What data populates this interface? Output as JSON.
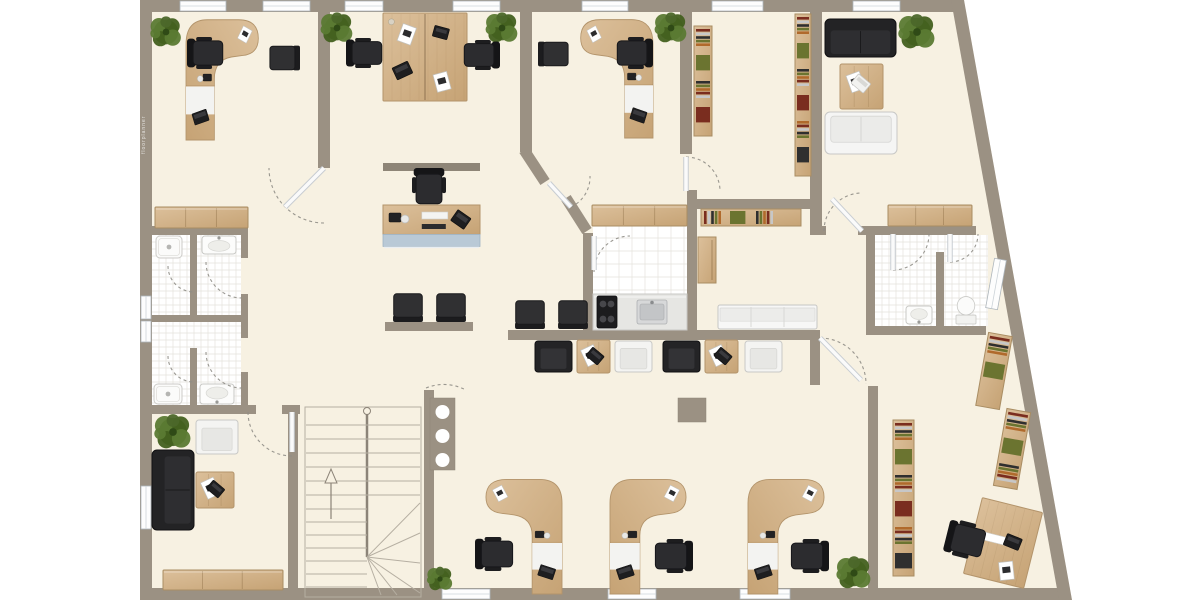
{
  "watermark": {
    "text": "floorplanner"
  },
  "palette": {
    "outside": "#ffffff",
    "floor": "#f7f1e2",
    "wall": "#9b9183",
    "wall_dark": "#8d8376",
    "wood1": "#dcc09b",
    "wood2": "#c6a375",
    "wood_line": "#b3946b",
    "dark": "#2c2c2f",
    "dark_edge": "#17171a",
    "white_f": "#f5f5f4",
    "white_edge": "#c8c8c6",
    "tile": "#ffffff",
    "tile_line": "#e4e2dd",
    "blue_front": "#b9c9d6",
    "blue_edge": "#9fb3c4",
    "window_frame": "#aeb6bc",
    "arc": "#8f8d86",
    "plant_a": "#4c672a",
    "plant_b": "#5b7a33",
    "plant_c": "#43601f",
    "books": [
      "#7a2d1f",
      "#c7c7c7",
      "#2f2f2f",
      "#6b7430",
      "#b06a2c"
    ]
  },
  "building": {
    "outline": [
      [
        140,
        0
      ],
      [
        964,
        0
      ],
      [
        1072,
        600
      ],
      [
        140,
        600
      ]
    ],
    "walls_ext": [
      [
        140,
        0,
        824,
        12
      ],
      [
        140,
        0,
        12,
        600
      ],
      [
        140,
        588,
        919,
        12
      ]
    ],
    "wall_slant": [
      [
        951,
        0
      ],
      [
        964,
        0
      ],
      [
        1072,
        600
      ],
      [
        1059,
        600
      ]
    ],
    "walls": [
      [
        318,
        12,
        12,
        156
      ],
      [
        520,
        12,
        12,
        140
      ],
      [
        680,
        12,
        12,
        142
      ],
      [
        810,
        12,
        12,
        218
      ],
      [
        152,
        226,
        96,
        9
      ],
      [
        190,
        235,
        7,
        82
      ],
      [
        190,
        348,
        7,
        57
      ],
      [
        241,
        226,
        7,
        32
      ],
      [
        241,
        294,
        7,
        44
      ],
      [
        241,
        372,
        7,
        36
      ],
      [
        152,
        315,
        96,
        7
      ],
      [
        152,
        405,
        104,
        9
      ],
      [
        282,
        405,
        18,
        9
      ],
      [
        288,
        405,
        10,
        193
      ],
      [
        424,
        390,
        10,
        208
      ],
      [
        385,
        322,
        88,
        9
      ],
      [
        508,
        330,
        302,
        10
      ],
      [
        810,
        330,
        10,
        55
      ],
      [
        868,
        386,
        10,
        202
      ],
      [
        687,
        199,
        127,
        10
      ],
      [
        687,
        190,
        10,
        142
      ],
      [
        583,
        233,
        10,
        99
      ],
      [
        866,
        226,
        110,
        9
      ],
      [
        866,
        226,
        9,
        108
      ],
      [
        936,
        252,
        8,
        83
      ],
      [
        866,
        326,
        120,
        9
      ],
      [
        810,
        226,
        16,
        9
      ],
      [
        858,
        226,
        8,
        9
      ]
    ],
    "diag_walls": [
      [
        524,
        150,
        545,
        182
      ],
      [
        566,
        198,
        587,
        231
      ]
    ],
    "windows_h": [
      [
        180,
        1,
        46
      ],
      [
        263,
        1,
        47
      ],
      [
        345,
        1,
        38
      ],
      [
        453,
        1,
        47
      ],
      [
        582,
        1,
        46
      ],
      [
        712,
        1,
        51
      ],
      [
        853,
        1,
        47
      ],
      [
        442,
        589,
        48
      ],
      [
        608,
        589,
        48
      ],
      [
        740,
        589,
        50
      ]
    ],
    "windows_v": [
      [
        141,
        296,
        23
      ],
      [
        141,
        321,
        21
      ],
      [
        141,
        486,
        43
      ]
    ],
    "window_slant": {
      "x": 990,
      "y": 259,
      "w": 12,
      "h": 50,
      "rot": 10.2,
      "cx": 996,
      "cy": 284
    },
    "tile_floors": [
      [
        152,
        235,
        89,
        170,
        7
      ],
      [
        875,
        235,
        113,
        91,
        7
      ],
      [
        593,
        225,
        94,
        105,
        13
      ]
    ],
    "pillar": [
      678,
      398,
      28,
      24
    ],
    "panel": {
      "x": 430,
      "y": 398,
      "w": 25,
      "h": 72,
      "holes": 3
    },
    "doors": [
      {
        "leaf": [
          324,
          168,
          285,
          207
        ],
        "arc": "M324 223 A55 55 0 0 1 269 168"
      },
      {
        "leaf": [
          549,
          183,
          571,
          207
        ],
        "arc": "M571 207 A33 33 0 0 0 590 176"
      },
      {
        "leaf": [
          686,
          157,
          686,
          191
        ],
        "arc": "M686 157 A34 34 0 0 1 720 191"
      },
      {
        "leaf": [
          862,
          231,
          832,
          199
        ],
        "arc": "M824 231 A38 38 0 0 1 862 193"
      },
      {
        "leaf": [
          820,
          338,
          861,
          380
        ],
        "arc": "M820 338 A46 46 0 0 1 866 384"
      },
      {
        "leaf": [
          893,
          234,
          893,
          270
        ],
        "arc": "M893 270 A36 36 0 0 0 929 234"
      },
      {
        "leaf": [
          950,
          234,
          950,
          262
        ],
        "arc": "M950 262 A28 28 0 0 0 978 234"
      },
      {
        "leaf": [
          292,
          412,
          292,
          452
        ],
        "arc": "M248 412 A44 44 0 0 0 292 456"
      },
      {
        "leaf": [
          594,
          236,
          594,
          270
        ],
        "arc": "M594 272 A36 36 0 0 1 630 236"
      },
      {
        "leaf": null,
        "arc": "M206 262 A36 36 0 0 0 242 298"
      },
      {
        "leaf": null,
        "arc": "M206 352 A36 36 0 0 0 242 388"
      },
      {
        "leaf": null,
        "arc": "M168 266 A26 26 0 0 0 194 292"
      },
      {
        "leaf": null,
        "arc": "M168 356 A26 26 0 0 0 194 382"
      },
      {
        "leaf": null,
        "arc": "M426 388 Q446 380 466 390"
      }
    ]
  },
  "stairs": {
    "x": 305,
    "y": 407,
    "w": 116,
    "h": 190
  },
  "furniture": [
    {
      "type": "plant",
      "name": "plant-office-1",
      "x": 152,
      "y": 18,
      "w": 28,
      "h": 28
    },
    {
      "type": "plant",
      "name": "plant-open-office-left",
      "x": 322,
      "y": 14,
      "w": 30,
      "h": 28
    },
    {
      "type": "plant",
      "name": "plant-open-office-right",
      "x": 487,
      "y": 14,
      "w": 30,
      "h": 28
    },
    {
      "type": "plant",
      "name": "plant-office-3",
      "x": 656,
      "y": 14,
      "w": 30,
      "h": 28
    },
    {
      "type": "plant",
      "name": "plant-lounge",
      "x": 900,
      "y": 16,
      "w": 34,
      "h": 32
    },
    {
      "type": "plant",
      "name": "plant-waiting-room",
      "x": 156,
      "y": 416,
      "w": 34,
      "h": 32
    },
    {
      "type": "plant",
      "name": "plant-bottom-right",
      "x": 838,
      "y": 558,
      "w": 32,
      "h": 30
    },
    {
      "type": "plant",
      "name": "plant-bottom-center",
      "x": 428,
      "y": 568,
      "w": 24,
      "h": 22
    },
    {
      "type": "desk-curved",
      "name": "desk-office-1",
      "x": 186,
      "y": 12,
      "w": 78,
      "h": 128,
      "mirror": true
    },
    {
      "type": "office-chair",
      "name": "chair-office-1",
      "x": 190,
      "y": 34,
      "w": 32,
      "h": 38,
      "rot": -90
    },
    {
      "type": "chair-visitor",
      "name": "visitor-chair-office-1",
      "x": 270,
      "y": 42,
      "w": 28,
      "h": 32,
      "rot": 90
    },
    {
      "type": "desk-double",
      "name": "double-desk-open-office",
      "x": 383,
      "y": 13,
      "w": 84,
      "h": 88
    },
    {
      "type": "office-chair",
      "name": "chair-open-office-left",
      "x": 350,
      "y": 34,
      "w": 30,
      "h": 38,
      "rot": -90
    },
    {
      "type": "office-chair",
      "name": "chair-open-office-right",
      "x": 466,
      "y": 36,
      "w": 30,
      "h": 38,
      "rot": 90
    },
    {
      "type": "desk-curved",
      "name": "desk-office-3",
      "x": 575,
      "y": 12,
      "w": 78,
      "h": 126
    },
    {
      "type": "office-chair",
      "name": "chair-office-3",
      "x": 618,
      "y": 34,
      "w": 32,
      "h": 38,
      "rot": 90
    },
    {
      "type": "chair-visitor",
      "name": "visitor-chair-office-3",
      "x": 540,
      "y": 38,
      "w": 28,
      "h": 32,
      "rot": -90
    },
    {
      "type": "shelf-books",
      "name": "bookshelf-storage-left",
      "x": 694,
      "y": 26,
      "w": 18,
      "h": 110
    },
    {
      "type": "shelf-books",
      "name": "bookshelf-storage-right",
      "x": 795,
      "y": 14,
      "w": 16,
      "h": 162
    },
    {
      "type": "sofa-dark",
      "name": "sofa-lounge-dark",
      "x": 825,
      "y": 19,
      "w": 71,
      "h": 38
    },
    {
      "type": "table-wood",
      "name": "coffee-table-lounge",
      "x": 840,
      "y": 64,
      "w": 43,
      "h": 45,
      "deco": "laptop-white"
    },
    {
      "type": "sofa-white",
      "name": "sofa-lounge-white",
      "x": 825,
      "y": 112,
      "w": 72,
      "h": 42,
      "rot": 180
    },
    {
      "type": "sideboard",
      "name": "sideboard-lounge",
      "x": 888,
      "y": 205,
      "w": 84,
      "h": 21
    },
    {
      "type": "sideboard",
      "name": "sideboard-corridor-left",
      "x": 155,
      "y": 207,
      "w": 93,
      "h": 21
    },
    {
      "type": "wall-shelf",
      "name": "wall-shelf-reception",
      "x": 383,
      "y": 163,
      "w": 97,
      "h": 8
    },
    {
      "type": "office-chair",
      "name": "chair-reception",
      "x": 412,
      "y": 168,
      "w": 34,
      "h": 38
    },
    {
      "type": "reception-desk",
      "name": "reception-desk",
      "x": 383,
      "y": 205,
      "w": 97,
      "h": 46
    },
    {
      "type": "chair-visitor",
      "name": "waiting-chair-1",
      "x": 391,
      "y": 292,
      "w": 34,
      "h": 30,
      "rot": 180
    },
    {
      "type": "chair-visitor",
      "name": "waiting-chair-2",
      "x": 434,
      "y": 292,
      "w": 34,
      "h": 30,
      "rot": 180
    },
    {
      "type": "chair-visitor",
      "name": "waiting-chair-3",
      "x": 513,
      "y": 299,
      "w": 34,
      "h": 30,
      "rot": 180
    },
    {
      "type": "chair-visitor",
      "name": "waiting-chair-4",
      "x": 556,
      "y": 299,
      "w": 34,
      "h": 30,
      "rot": 180
    },
    {
      "type": "sideboard",
      "name": "kitchen-upper-cabinets",
      "x": 592,
      "y": 205,
      "w": 95,
      "h": 21
    },
    {
      "type": "shelf-books",
      "name": "bookshelf-corridor-row",
      "x": 701,
      "y": 209,
      "w": 100,
      "h": 17
    },
    {
      "type": "cabinet-tall",
      "name": "kitchen-tall-cabinet",
      "x": 698,
      "y": 237,
      "w": 18,
      "h": 46
    },
    {
      "type": "counter",
      "name": "kitchen-counter",
      "x": 593,
      "y": 294,
      "w": 94,
      "h": 36
    },
    {
      "type": "stove",
      "name": "kitchen-stove",
      "x": 597,
      "y": 296,
      "w": 20,
      "h": 32
    },
    {
      "type": "sink",
      "name": "kitchen-sink",
      "x": 637,
      "y": 300,
      "w": 30,
      "h": 24
    },
    {
      "type": "armchair-dark",
      "name": "armchair-dark-1",
      "x": 535,
      "y": 341,
      "w": 37,
      "h": 31
    },
    {
      "type": "table-wood",
      "name": "side-table-1",
      "x": 577,
      "y": 340,
      "w": 33,
      "h": 33,
      "deco": "laptop-dark"
    },
    {
      "type": "armchair-white",
      "name": "armchair-white-1",
      "x": 615,
      "y": 341,
      "w": 37,
      "h": 31
    },
    {
      "type": "armchair-dark",
      "name": "armchair-dark-2",
      "x": 663,
      "y": 341,
      "w": 37,
      "h": 31
    },
    {
      "type": "table-wood",
      "name": "side-table-2",
      "x": 705,
      "y": 340,
      "w": 33,
      "h": 33,
      "deco": "laptop-dark"
    },
    {
      "type": "armchair-white",
      "name": "armchair-white-2",
      "x": 745,
      "y": 341,
      "w": 37,
      "h": 31
    },
    {
      "type": "bench-white",
      "name": "bench-white",
      "x": 718,
      "y": 305,
      "w": 99,
      "h": 24
    },
    {
      "type": "shower",
      "name": "shower-bath-upper",
      "x": 156,
      "y": 236,
      "w": 26,
      "h": 22
    },
    {
      "type": "sink-bath",
      "name": "sink-bath-upper",
      "x": 202,
      "y": 236,
      "w": 34,
      "h": 18
    },
    {
      "type": "shower",
      "name": "shower-bath-lower",
      "x": 154,
      "y": 384,
      "w": 28,
      "h": 20,
      "rot": 180
    },
    {
      "type": "sink-bath",
      "name": "sink-bath-lower",
      "x": 200,
      "y": 384,
      "w": 34,
      "h": 20,
      "rot": 180
    },
    {
      "type": "sink-bath",
      "name": "sink-bath-right",
      "x": 906,
      "y": 306,
      "w": 26,
      "h": 18,
      "rot": 180
    },
    {
      "type": "toilet",
      "name": "toilet-right",
      "x": 956,
      "y": 296,
      "w": 20,
      "h": 28,
      "rot": 180
    },
    {
      "type": "armchair-white",
      "name": "armchair-waiting-room",
      "x": 196,
      "y": 420,
      "w": 42,
      "h": 34
    },
    {
      "type": "sofa-dark",
      "name": "sofa-waiting-room",
      "x": 133,
      "y": 469,
      "w": 80,
      "h": 42,
      "rot": -90
    },
    {
      "type": "table-wood",
      "name": "coffee-table-waiting-room",
      "x": 196,
      "y": 472,
      "w": 38,
      "h": 36,
      "deco": "laptop-dark"
    },
    {
      "type": "sideboard",
      "name": "sideboard-waiting-room",
      "x": 163,
      "y": 570,
      "w": 120,
      "h": 20
    },
    {
      "type": "desk-curved",
      "name": "workstation-desk-1",
      "x": 480,
      "y": 472,
      "w": 82,
      "h": 122
    },
    {
      "type": "office-chair",
      "name": "workstation-chair-1",
      "x": 478,
      "y": 534,
      "w": 34,
      "h": 40,
      "rot": -90
    },
    {
      "type": "desk-curved",
      "name": "workstation-desk-2",
      "x": 610,
      "y": 472,
      "w": 82,
      "h": 122,
      "mirror": true
    },
    {
      "type": "office-chair",
      "name": "workstation-chair-2",
      "x": 656,
      "y": 536,
      "w": 34,
      "h": 40,
      "rot": 90
    },
    {
      "type": "desk-curved",
      "name": "workstation-desk-3",
      "x": 748,
      "y": 472,
      "w": 82,
      "h": 122,
      "mirror": true
    },
    {
      "type": "office-chair",
      "name": "workstation-chair-3",
      "x": 792,
      "y": 536,
      "w": 34,
      "h": 40,
      "rot": 90
    },
    {
      "type": "shelf-books",
      "name": "bookshelf-office-br",
      "x": 893,
      "y": 420,
      "w": 21,
      "h": 156
    },
    {
      "type": "shelf-books",
      "name": "bookshelf-slant-1",
      "x": 982,
      "y": 334,
      "w": 24,
      "h": 74,
      "rot": 10
    },
    {
      "type": "shelf-books",
      "name": "bookshelf-slant-2",
      "x": 1000,
      "y": 410,
      "w": 24,
      "h": 78,
      "rot": 10
    },
    {
      "type": "desk-rect",
      "name": "desk-office-br",
      "x": 972,
      "y": 504,
      "w": 62,
      "h": 78,
      "rot": 14
    },
    {
      "type": "office-chair",
      "name": "chair-office-br",
      "x": 948,
      "y": 520,
      "w": 36,
      "h": 40,
      "rot": -76
    }
  ]
}
